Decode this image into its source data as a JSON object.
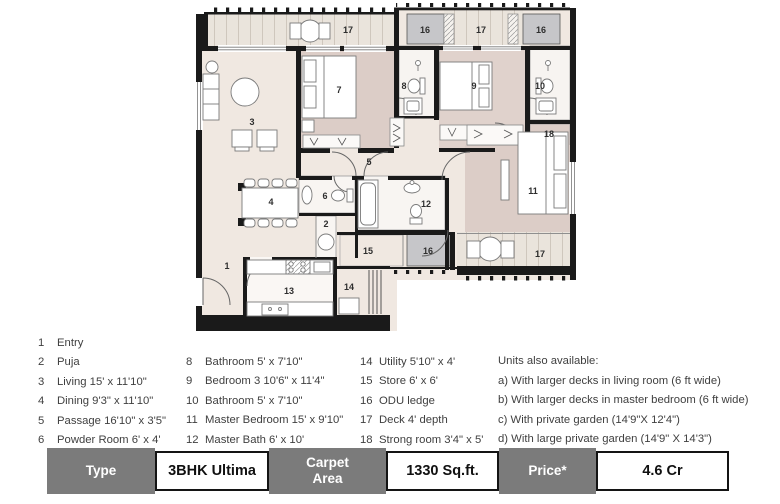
{
  "plan": {
    "labels": {
      "deck_top_left": "17",
      "odu_top_left": "16",
      "deck_top_mid": "17",
      "odu_top_right": "16",
      "living": "3",
      "bed2": "7",
      "bath1": "8",
      "bed3": "9",
      "bath2": "10",
      "strong": "18",
      "passage": "5",
      "master_bed": "11",
      "powder": "6",
      "master_bath": "12",
      "puja": "2",
      "dining": "4",
      "entry": "1",
      "store": "15",
      "odu_bottom": "16",
      "deck_right": "17",
      "kitchen": "13",
      "utility": "14"
    },
    "colors": {
      "wall": "#1a1a1a",
      "floor_cream": "#f0e8e1",
      "floor_pink": "#dccdc7",
      "floor_deck": "#eae4dc",
      "odu_gray": "#c6c6c9"
    }
  },
  "legend": {
    "col1": [
      {
        "num": "1",
        "text": "Entry"
      },
      {
        "num": "2",
        "text": "Puja"
      },
      {
        "num": "3",
        "text": "Living  15' x 11'10\""
      },
      {
        "num": "4",
        "text": "Dining  9'3\" x 11'10\""
      },
      {
        "num": "5",
        "text": "Passage  16'10\" x 3'5\""
      },
      {
        "num": "6",
        "text": "Powder Room  6' x 4'"
      }
    ],
    "col2": [
      {
        "num": "8",
        "text": "Bathroom  5' x 7'10\""
      },
      {
        "num": "9",
        "text": "Bedroom 3  10'6\" x 11'4\""
      },
      {
        "num": "10",
        "text": "Bathroom  5' x 7'10\""
      },
      {
        "num": "11",
        "text": "Master Bedroom  15' x 9'10\""
      },
      {
        "num": "12",
        "text": "Master Bath  6' x 10'"
      }
    ],
    "col3": [
      {
        "num": "14",
        "text": "Utility  5'10\" x 4'"
      },
      {
        "num": "15",
        "text": "Store  6' x 6'"
      },
      {
        "num": "16",
        "text": "ODU ledge"
      },
      {
        "num": "17",
        "text": "Deck  4' depth"
      },
      {
        "num": "18",
        "text": "Strong room  3'4\" x 5'"
      }
    ],
    "notes": {
      "title": "Units also available:",
      "items": [
        "a) With larger decks in living room (6 ft wide)",
        "b) With larger decks in master bedroom (6 ft wide)",
        "c) With private garden (14'9\"X 12'4\")",
        "d) With large private garden  (14'9\" X 14'3\")"
      ]
    }
  },
  "summary_table": {
    "header_bg": "#7b7b7b",
    "header_text": "#ffffff",
    "cells": [
      {
        "label": "Type",
        "header": true
      },
      {
        "label": "3BHK Ultima",
        "header": false
      },
      {
        "label": "Carpet Area",
        "header": true
      },
      {
        "label": "1330 Sq.ft.",
        "header": false
      },
      {
        "label": "Price*",
        "header": true
      },
      {
        "label": "4.6 Cr",
        "header": false
      }
    ]
  }
}
